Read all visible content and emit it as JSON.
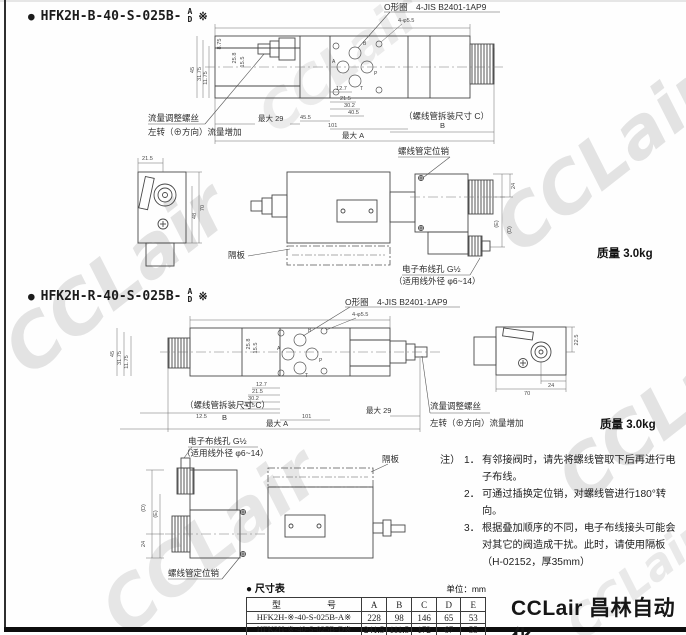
{
  "page": {
    "watermark_text": "CCLair",
    "logo_text": "CCLair 昌林自动化"
  },
  "labels": {
    "oring": "O形圈",
    "oring_std": "4-JIS B2401-1AP9",
    "holes": "4-φ5.5",
    "flow_screw": "流量调整螺丝",
    "flow_dir": "左转（⊕方向）流量增加",
    "max29": "最大 29",
    "sol_c": "（螺线管拆装尺寸 C）",
    "dim_b": "B",
    "max_a": "最大 A",
    "pin": "螺线管定位销",
    "partition": "隔板",
    "wiring": "电子布线孔 G½",
    "wire_od": "（适用线外径 φ6~14）",
    "weight": "质量 3.0kg",
    "dim_d": "(D)",
    "dim_e": "(E)",
    "dim_24": "24"
  },
  "dims": {
    "d1": "45",
    "d2": "31.75",
    "d3": "11.75",
    "d4": "25.8",
    "d5": "15.5",
    "d6": "8.75",
    "b1": "12.7",
    "b2": "21.5",
    "b3": "30.2",
    "b4": "40.5",
    "b5": "45.5",
    "b6": "101",
    "b7": "12.5"
  },
  "ports": {
    "a": "A",
    "b": "B",
    "p": "P",
    "t": "T"
  },
  "sections": [
    {
      "bullet": "●",
      "model": "HFK2H-B-40-S-025B-",
      "suffix_top": "A",
      "suffix_bottom": "D",
      "mark": "※",
      "end": {
        "d1": "21.5",
        "d2": "70",
        "d3": "48"
      }
    },
    {
      "bullet": "●",
      "model": "HFK2H-R-40-S-025B-",
      "suffix_top": "A",
      "suffix_bottom": "D",
      "mark": "※",
      "end": {
        "d1": "22.5",
        "d2": "24",
        "d3": "70"
      }
    }
  ],
  "notes": {
    "prefix": "注）",
    "items": [
      {
        "num": "1．",
        "text": "有邻接阀时，请先将螺线管取下后再进行电子布线。"
      },
      {
        "num": "2．",
        "text": "可通过插换定位销，对螺线管进行180°转向。"
      },
      {
        "num": "3．",
        "text": "根据叠加顺序的不同，电子布线接头可能会对其它的阀造成干扰。此时，请使用隔板（H-02152，厚35mm）"
      }
    ]
  },
  "table": {
    "heading_bullet": "●",
    "heading": "尺寸表",
    "unit": "单位：mm",
    "model_header_l": "型",
    "model_header_r": "号",
    "columns": [
      "A",
      "B",
      "C",
      "D",
      "E"
    ],
    "rows": [
      {
        "model": "HFK2H-※-40-S-025B-A※",
        "a": "228",
        "b": "98",
        "c": "146",
        "d": "65",
        "e": "53"
      },
      {
        "model": "HFK2H-※-40-S-025B-D※",
        "a": "241.5",
        "b": "111.5",
        "c": "172",
        "d": "67",
        "e": "55"
      }
    ]
  }
}
